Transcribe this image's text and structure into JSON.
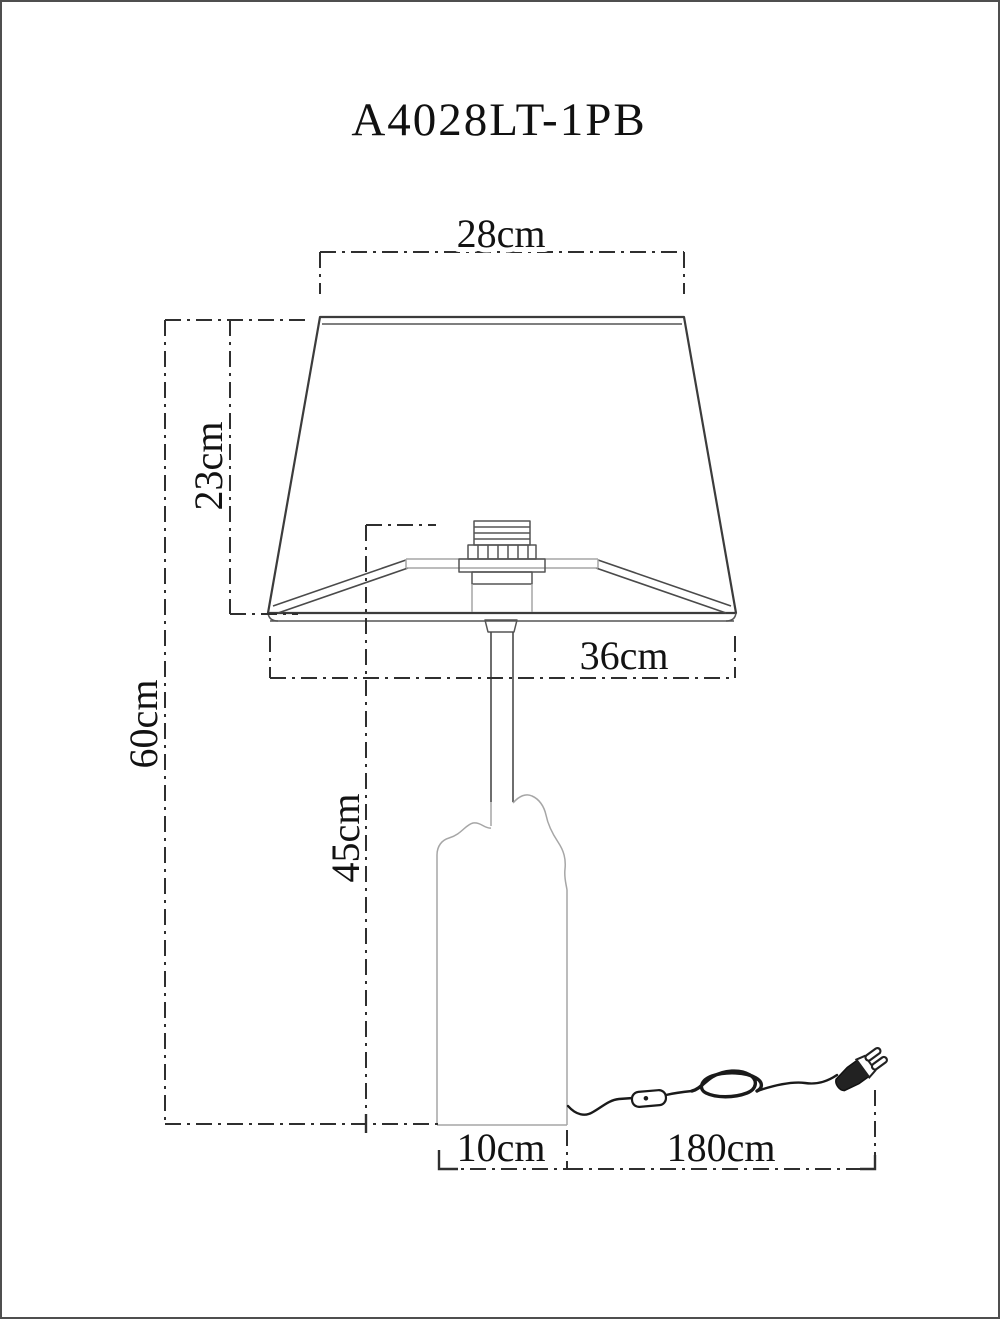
{
  "window": {
    "background": "#ffffff",
    "border_color": "#4f4f4f"
  },
  "title": "A4028LT-1PB",
  "colors": {
    "line": "#3c3c3c",
    "light_line": "#a6a6a6",
    "dimension_line": "#2f2f2f",
    "text": "#121212",
    "cord": "#1a1a1a"
  },
  "drawing": {
    "subject": "table-lamp-dimensional-drawing",
    "parts": [
      "lamp-shade",
      "socket",
      "stem",
      "glass-body",
      "power-cord",
      "inline-switch",
      "power-plug"
    ]
  },
  "dimensions": {
    "shade_top_width": "28cm",
    "shade_height": "23cm",
    "total_height": "60cm",
    "stand_height": "45cm",
    "shade_bottom_width": "36cm",
    "base_width": "10cm",
    "cord_length": "180cm"
  }
}
